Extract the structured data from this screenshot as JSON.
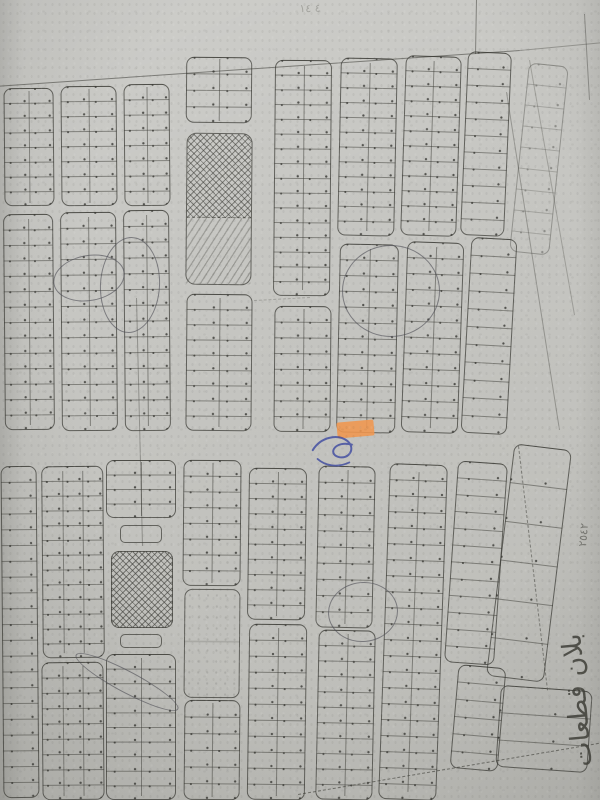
{
  "texts": {
    "plan_label": "بلان قطعات",
    "plot_number": "٢٥٤٢",
    "faint_marks": "٤ ١٤"
  },
  "colors": {
    "paper": "#c7c7c3",
    "ink": "#45453f",
    "ink_soft": "rgba(58,58,52,0.5)",
    "ink_dot": "rgba(38,38,34,0.72)",
    "pencil": "rgba(78,78,86,0.62)",
    "highlight_orange": "#f0964f",
    "pen_blue": "#3c49a0"
  },
  "map": {
    "blocks": [
      {
        "x": 4,
        "y": 88,
        "w": 50,
        "h": 118,
        "rows": 8,
        "cols": 2,
        "rot": -0.5
      },
      {
        "x": 61,
        "y": 86,
        "w": 56,
        "h": 120,
        "rows": 8,
        "cols": 2,
        "rot": -0.5
      },
      {
        "x": 124,
        "y": 84,
        "w": 46,
        "h": 122,
        "rows": 8,
        "cols": 2,
        "rot": -0.5
      },
      {
        "x": 186,
        "y": 57,
        "w": 66,
        "h": 66,
        "rows": 4,
        "cols": 2,
        "rot": 0.5
      },
      {
        "x": 186,
        "y": 133,
        "w": 66,
        "h": 152,
        "fill": "hatch",
        "rot": 0.5
      },
      {
        "x": 274,
        "y": 60,
        "w": 57,
        "h": 236,
        "rows": 16,
        "cols": 2,
        "rot": 0.5
      },
      {
        "x": 339,
        "y": 58,
        "w": 57,
        "h": 178,
        "rows": 12,
        "cols": 2,
        "rot": 1.2
      },
      {
        "x": 403,
        "y": 56,
        "w": 56,
        "h": 180,
        "rows": 12,
        "cols": 2,
        "rot": 1.8
      },
      {
        "x": 464,
        "y": 52,
        "w": 44,
        "h": 184,
        "rows": 11,
        "cols": 1,
        "rot": 2.5
      },
      {
        "x": 519,
        "y": 64,
        "w": 40,
        "h": 190,
        "rows": 9,
        "cols": 1,
        "rot": 6,
        "faint": true
      },
      {
        "x": 4,
        "y": 214,
        "w": 50,
        "h": 216,
        "rows": 14,
        "cols": 2,
        "rot": -0.5
      },
      {
        "x": 61,
        "y": 212,
        "w": 56,
        "h": 219,
        "rows": 14,
        "cols": 2,
        "rot": -0.5
      },
      {
        "x": 124,
        "y": 210,
        "w": 46,
        "h": 221,
        "rows": 14,
        "cols": 2,
        "rot": -0.5
      },
      {
        "x": 186,
        "y": 294,
        "w": 66,
        "h": 137,
        "rows": 9,
        "cols": 2,
        "rot": 0.5
      },
      {
        "x": 274,
        "y": 306,
        "w": 57,
        "h": 126,
        "rows": 8,
        "cols": 2,
        "rot": 0.5
      },
      {
        "x": 338,
        "y": 244,
        "w": 59,
        "h": 189,
        "rows": 12,
        "cols": 2,
        "rot": 1.2
      },
      {
        "x": 404,
        "y": 242,
        "w": 57,
        "h": 191,
        "rows": 12,
        "cols": 2,
        "rot": 2
      },
      {
        "x": 466,
        "y": 238,
        "w": 46,
        "h": 196,
        "rows": 11,
        "cols": 1,
        "rot": 3.2
      },
      {
        "x": 2,
        "y": 466,
        "w": 36,
        "h": 332,
        "rows": 21,
        "cols": 1,
        "rot": -0.5
      },
      {
        "x": 42,
        "y": 466,
        "w": 62,
        "h": 192,
        "rows": 13,
        "cols": 3,
        "rot": -0.5
      },
      {
        "x": 42,
        "y": 662,
        "w": 62,
        "h": 138,
        "rows": 9,
        "cols": 3,
        "rot": -0.5
      },
      {
        "x": 106,
        "y": 460,
        "w": 70,
        "h": 58,
        "rows": 4,
        "cols": 2,
        "rot": 0
      },
      {
        "x": 106,
        "y": 520,
        "w": 70,
        "h": 28,
        "fill": "bracket",
        "rot": 0
      },
      {
        "x": 111,
        "y": 551,
        "w": 62,
        "h": 77,
        "fill": "cross",
        "rot": 0
      },
      {
        "x": 106,
        "y": 630,
        "w": 70,
        "h": 22,
        "fill": "bracket",
        "rot": 0
      },
      {
        "x": 106,
        "y": 654,
        "w": 70,
        "h": 146,
        "rows": 10,
        "cols": 2,
        "rot": 0
      },
      {
        "x": 183,
        "y": 460,
        "w": 58,
        "h": 126,
        "rows": 8,
        "cols": 2,
        "rot": 0.5
      },
      {
        "x": 184,
        "y": 589,
        "w": 56,
        "h": 109,
        "fill": "plain",
        "rot": 0.5
      },
      {
        "x": 184,
        "y": 700,
        "w": 56,
        "h": 100,
        "rows": 6,
        "cols": 2,
        "rot": 0.5
      },
      {
        "x": 248,
        "y": 468,
        "w": 58,
        "h": 152,
        "rows": 10,
        "cols": 2,
        "rot": 0.8
      },
      {
        "x": 248,
        "y": 624,
        "w": 58,
        "h": 176,
        "rows": 11,
        "cols": 2,
        "rot": 0.8
      },
      {
        "x": 317,
        "y": 466,
        "w": 57,
        "h": 162,
        "rows": 10,
        "cols": 2,
        "rot": 1.2
      },
      {
        "x": 317,
        "y": 630,
        "w": 57,
        "h": 170,
        "rows": 11,
        "cols": 2,
        "rot": 1.2
      },
      {
        "x": 384,
        "y": 464,
        "w": 58,
        "h": 336,
        "rows": 21,
        "cols": 2,
        "rot": 2
      },
      {
        "x": 451,
        "y": 462,
        "w": 50,
        "h": 202,
        "rows": 12,
        "cols": 1,
        "rot": 4
      },
      {
        "x": 454,
        "y": 666,
        "w": 48,
        "h": 104,
        "rows": 6,
        "cols": 1,
        "rot": 5
      },
      {
        "x": 500,
        "y": 446,
        "w": 58,
        "h": 234,
        "rows": 6,
        "cols": 1,
        "rot": 7,
        "fill": "sparse"
      },
      {
        "x": 498,
        "y": 688,
        "w": 92,
        "h": 82,
        "rows": 3,
        "cols": 1,
        "rot": 4,
        "fill": "sparse"
      }
    ],
    "lines": [
      {
        "x1": -6,
        "y1": 86,
        "x2": 520,
        "y2": 50,
        "w": 1.5,
        "a": 0.55
      },
      {
        "x1": 520,
        "y1": 50,
        "x2": 604,
        "y2": 42,
        "w": 1.2,
        "a": 0.35
      },
      {
        "x1": 477,
        "y1": 0,
        "x2": 476,
        "y2": 54,
        "w": 1.4,
        "a": 0.5
      },
      {
        "x1": 585,
        "y1": 14,
        "x2": 590,
        "y2": 100,
        "w": 1.3,
        "a": 0.4
      },
      {
        "x1": 507,
        "y1": 92,
        "x2": 560,
        "y2": 430,
        "w": 1.2,
        "a": 0.35
      },
      {
        "x1": 530,
        "y1": 60,
        "x2": 575,
        "y2": 315,
        "w": 1.0,
        "a": 0.28
      },
      {
        "x1": 298,
        "y1": 794,
        "x2": 604,
        "y2": 742,
        "w": 1.6,
        "a": 0.6,
        "dash": true
      },
      {
        "x1": 519,
        "y1": 446,
        "x2": 548,
        "y2": 690,
        "w": 1.4,
        "a": 0.5,
        "dash": true
      },
      {
        "x1": 137,
        "y1": 298,
        "x2": 143,
        "y2": 546,
        "w": 1.4,
        "a": 0.38
      },
      {
        "x1": 254,
        "y1": 300,
        "x2": 310,
        "y2": 297,
        "w": 1.0,
        "a": 0.25,
        "dash": true
      }
    ],
    "pencil_ellipses": [
      {
        "cx": 88,
        "cy": 277,
        "rx": 35,
        "ry": 22,
        "rot": -10
      },
      {
        "cx": 129,
        "cy": 284,
        "rx": 29,
        "ry": 47,
        "rot": 3
      },
      {
        "cx": 390,
        "cy": 290,
        "rx": 48,
        "ry": 45,
        "rot": 0
      },
      {
        "cx": 362,
        "cy": 611,
        "rx": 34,
        "ry": 29,
        "rot": -5
      },
      {
        "cx": 126,
        "cy": 681,
        "rx": 57,
        "ry": 10,
        "rot": 28
      }
    ],
    "highlight": {
      "x": 337,
      "y": 421,
      "w": 37,
      "h": 16,
      "rot": -5
    },
    "pen_scribble_box": {
      "x": 305,
      "y": 426,
      "w": 70,
      "h": 48,
      "rot": 8
    }
  }
}
